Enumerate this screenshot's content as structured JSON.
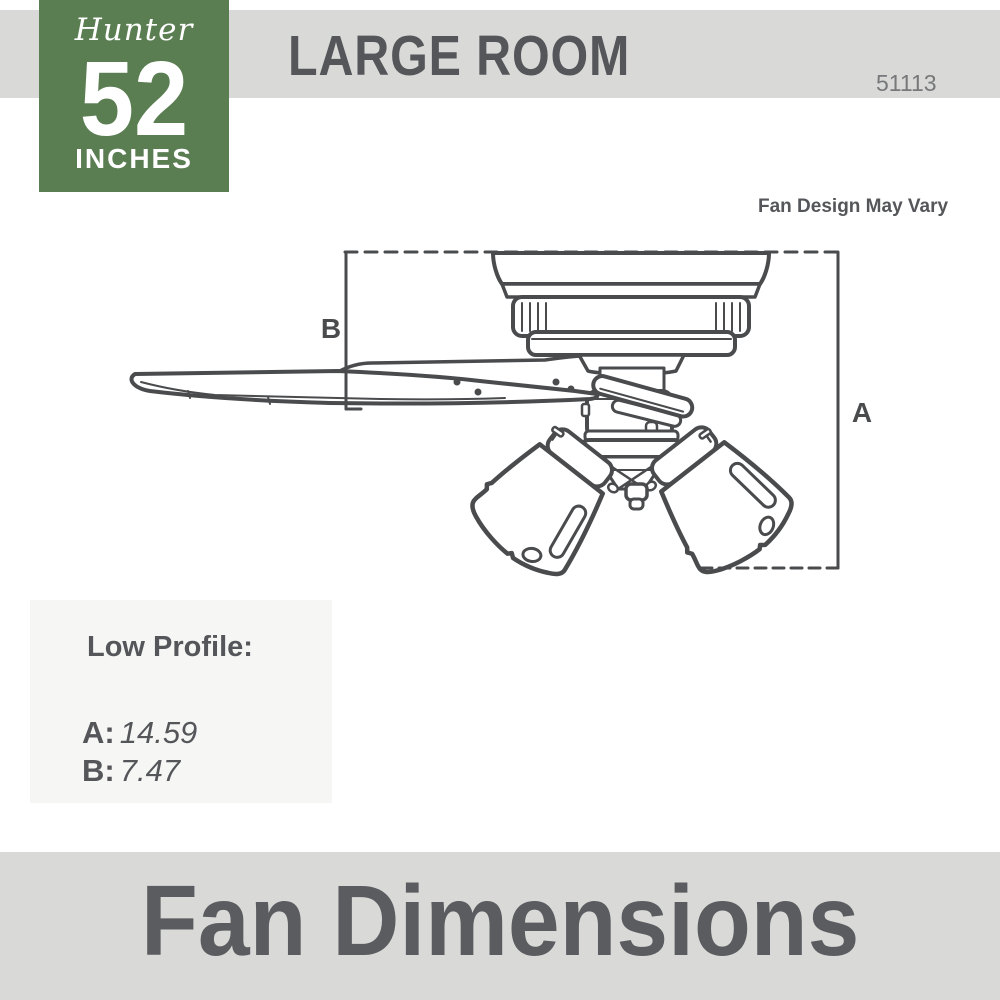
{
  "colors": {
    "accent_green": "#5a7e52",
    "band_gray": "#d9dad8",
    "line_art": "#4a4b4d",
    "text_dark": "#55565a",
    "model_gray": "#77787a"
  },
  "badge": {
    "brand": "Hunter",
    "size_number": "52",
    "size_unit": "INCHES"
  },
  "header": {
    "title": "LARGE ROOM",
    "model_number": "51113"
  },
  "diagram": {
    "note": "Fan Design May Vary",
    "dim_a_label": "A",
    "dim_b_label": "B"
  },
  "panel": {
    "title": "Low Profile:",
    "rows": [
      {
        "label": "A:",
        "value": "14.59"
      },
      {
        "label": "B:",
        "value": "7.47"
      }
    ]
  },
  "footer": {
    "title": "Fan Dimensions"
  }
}
